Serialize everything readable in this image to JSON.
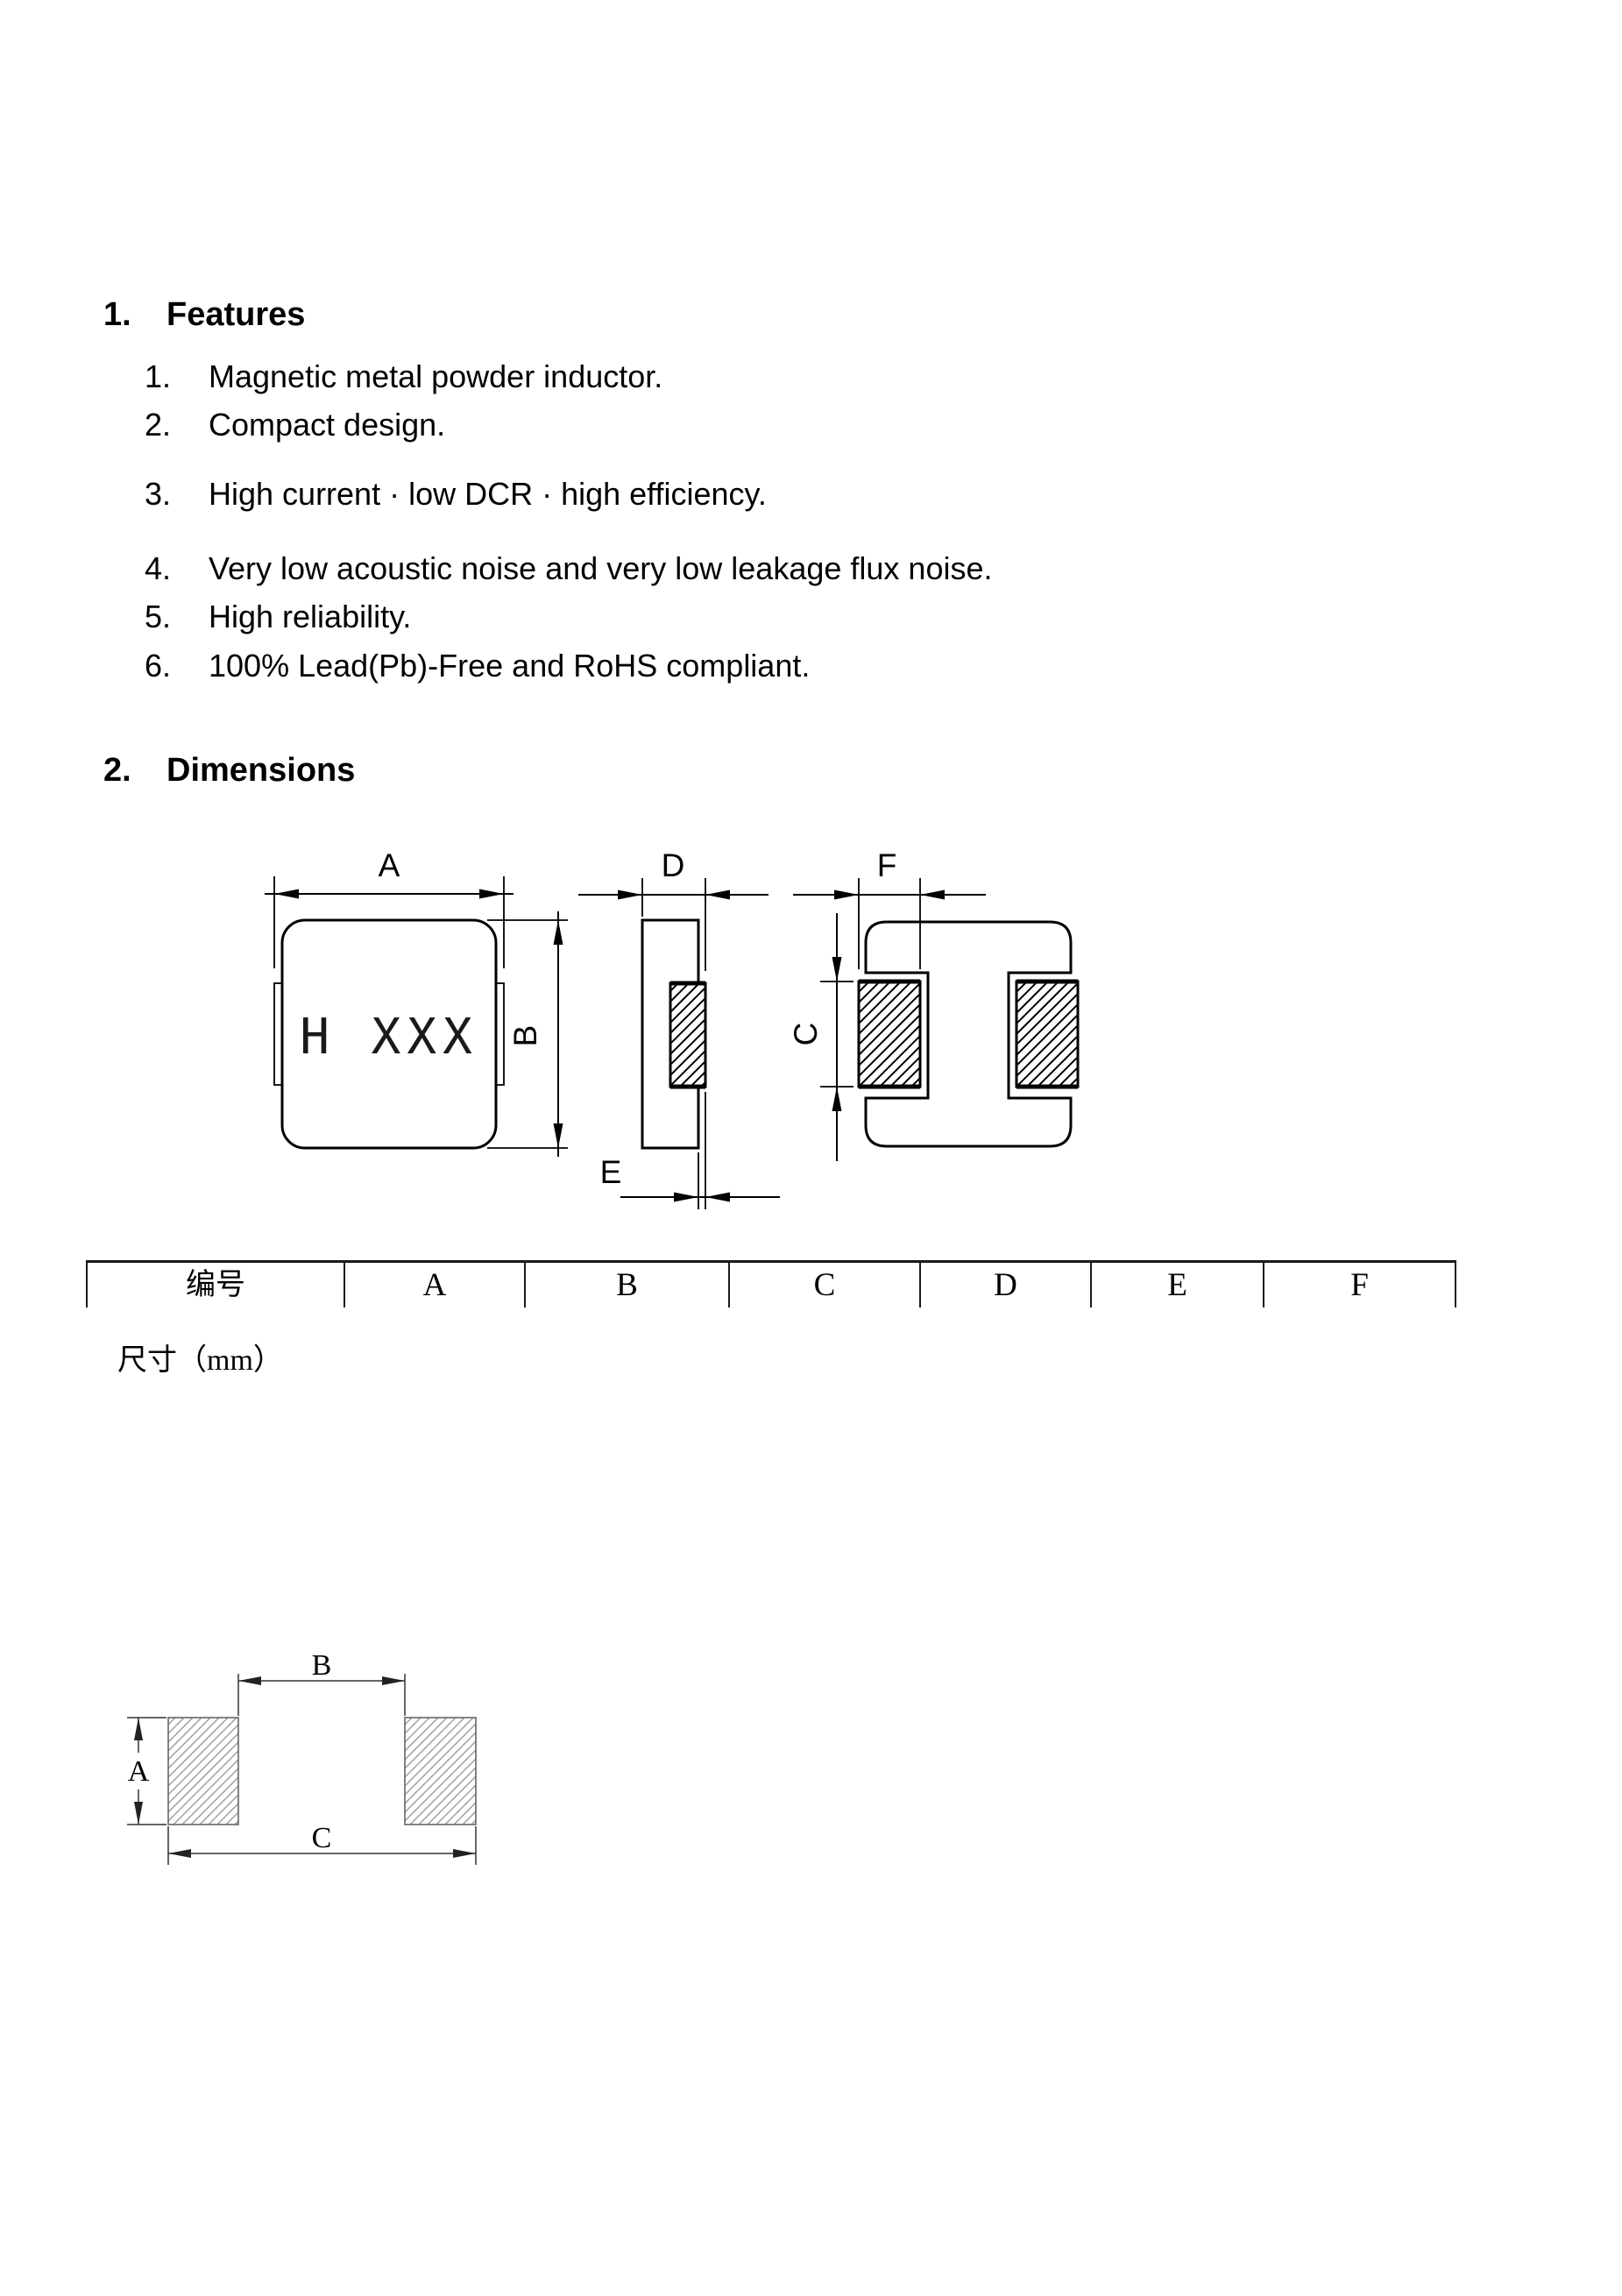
{
  "sections": {
    "features": {
      "number": "1.",
      "title": "Features",
      "items": [
        {
          "num": "1.",
          "text": "Magnetic metal powder inductor."
        },
        {
          "num": "2.",
          "text": "Compact design."
        },
        {
          "num": "3.",
          "text": "High current · low DCR · high efficiency."
        },
        {
          "num": "4.",
          "text": "Very low acoustic noise and very low leakage flux noise."
        },
        {
          "num": "5.",
          "text": "High reliability."
        },
        {
          "num": "6.",
          "text": "100% Lead(Pb)-Free and RoHS compliant."
        }
      ]
    },
    "dimensions": {
      "number": "2.",
      "title": "Dimensions"
    }
  },
  "drawings": {
    "top_view": {
      "marking_display": "H XXX",
      "dim_a": "A",
      "dim_b": "B"
    },
    "side_view": {
      "dim_d": "D",
      "dim_e": "E"
    },
    "bottom_view": {
      "dim_f": "F",
      "dim_c": "C"
    },
    "land_pattern": {
      "dim_a": "A",
      "dim_b": "B",
      "dim_c": "C"
    }
  },
  "table": {
    "headers": [
      "编号",
      "A",
      "B",
      "C",
      "D",
      "E",
      "F"
    ],
    "unit_row_label": "尺寸（mm）"
  },
  "colors": {
    "ink": "#000000",
    "paper": "#ffffff",
    "hatch_gray": "#9a9a9a"
  }
}
